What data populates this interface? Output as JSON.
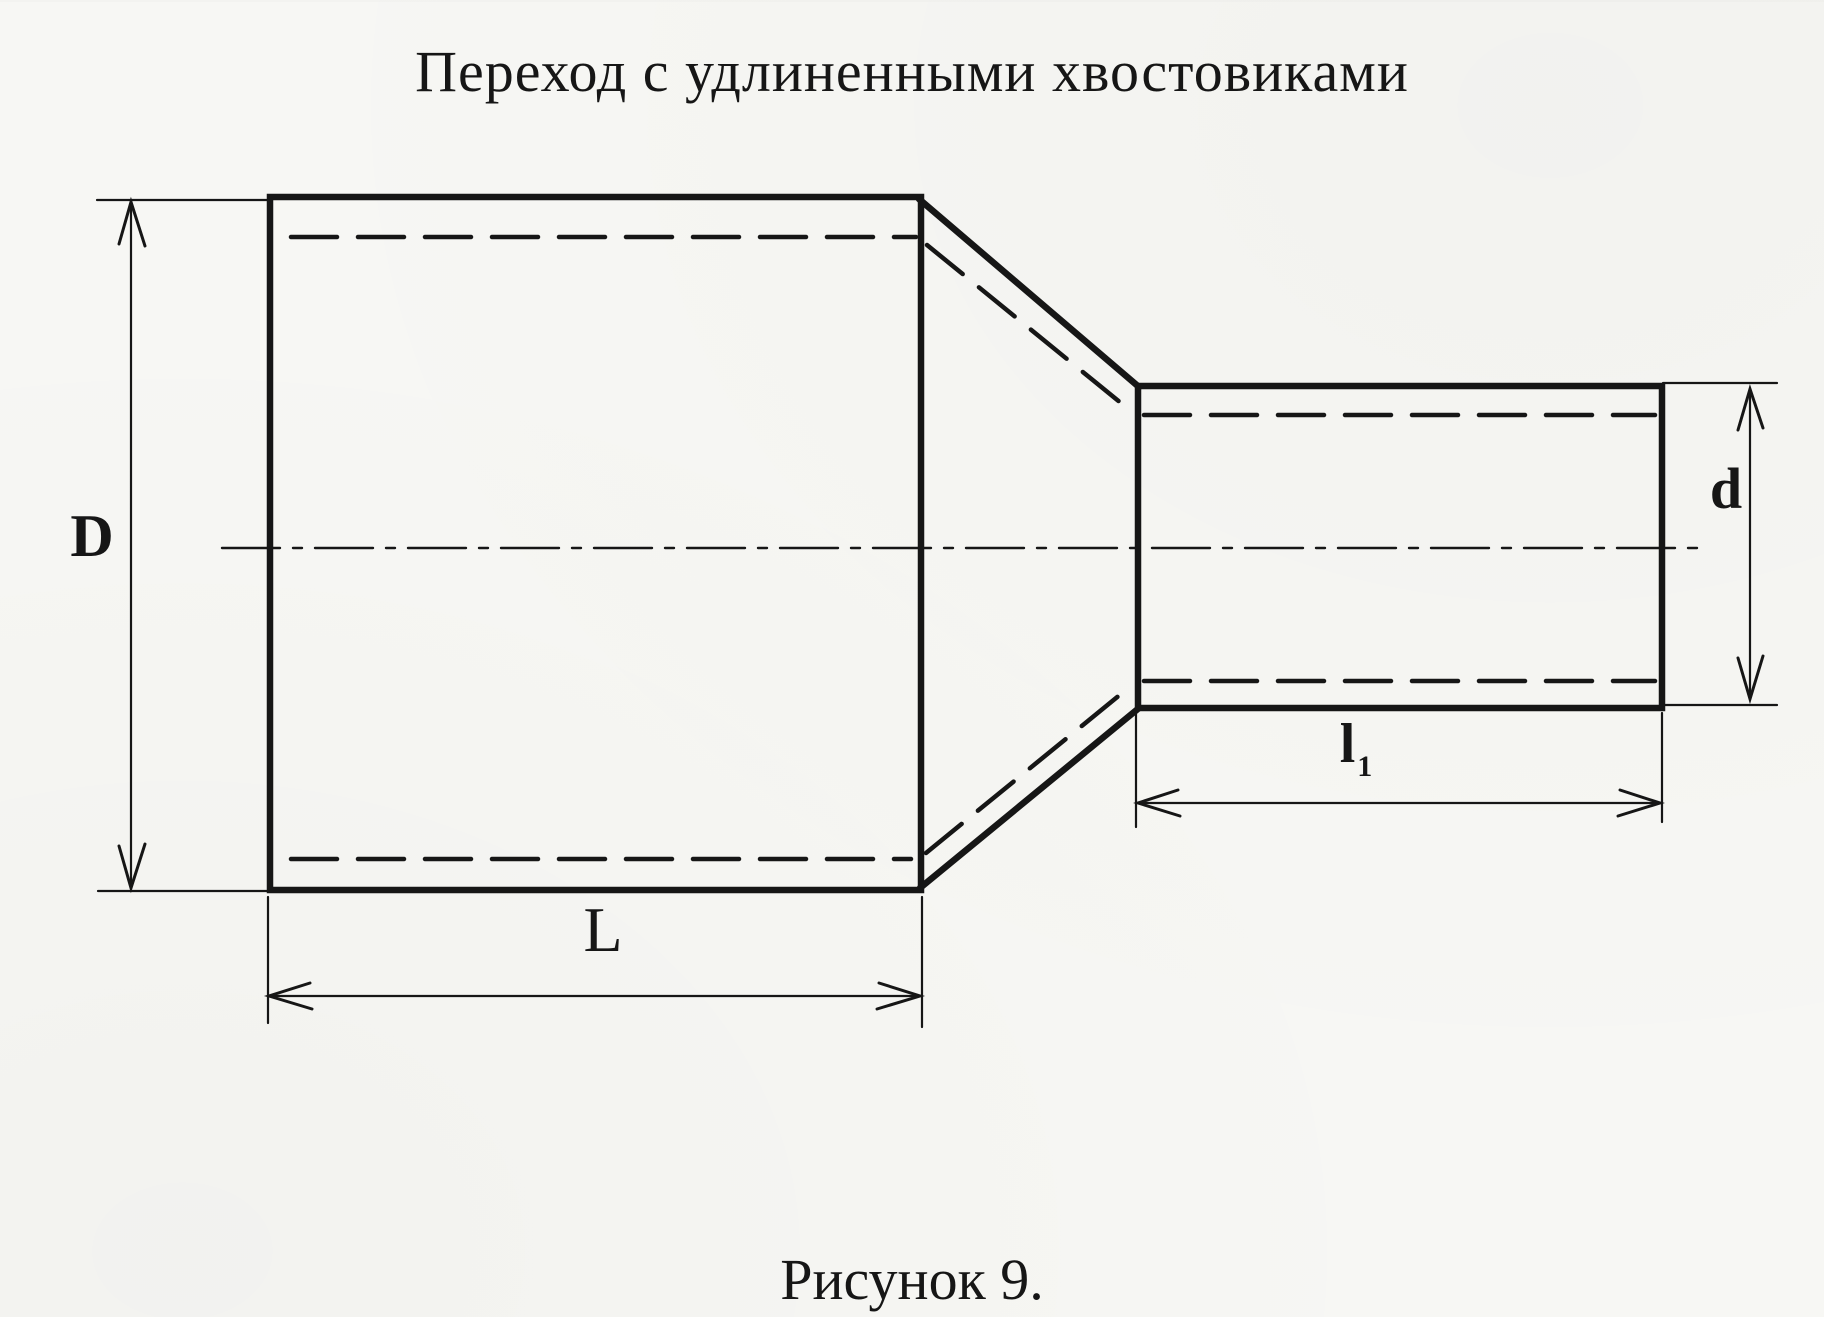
{
  "page": {
    "background": "#f7f7f4",
    "ink_color": "#161616"
  },
  "title": {
    "text": "Переход с удлиненными хвостовиками"
  },
  "caption": {
    "text": "Рисунок 9."
  },
  "diagram": {
    "labels": {
      "large_diameter": "D",
      "large_length": "L",
      "small_diameter": "d",
      "small_length_base": "l",
      "small_length_subscript": "1"
    }
  }
}
